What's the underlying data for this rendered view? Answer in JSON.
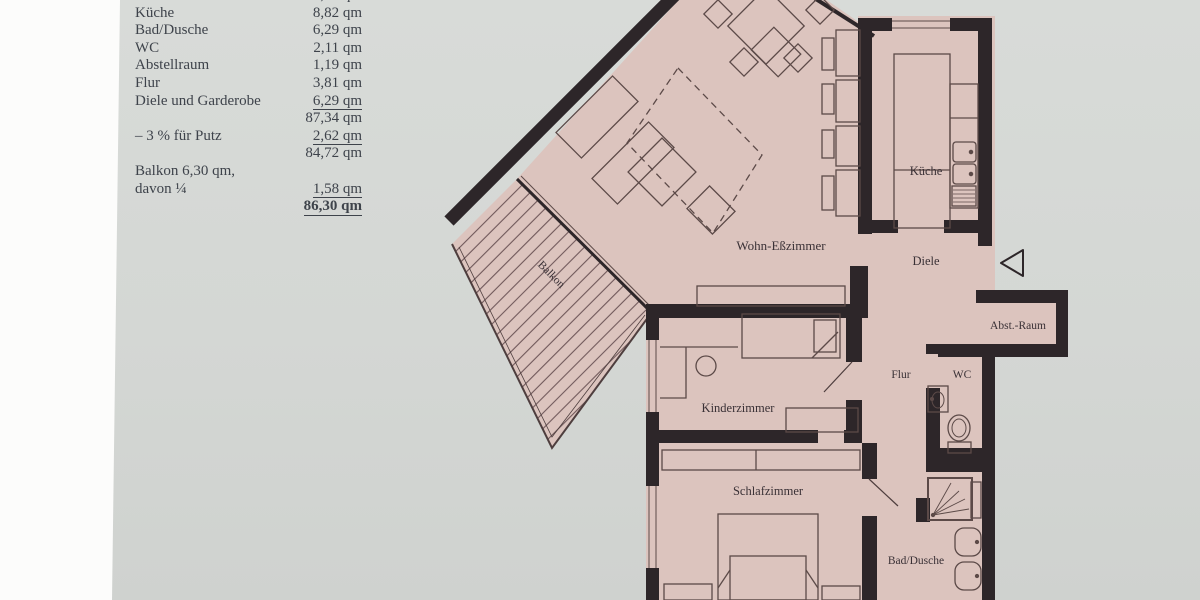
{
  "table": {
    "rows": [
      {
        "label": "Wohn- und Eßzimmer",
        "value": "58,83 qm"
      },
      {
        "label": "Küche",
        "value": "8,82 qm"
      },
      {
        "label": "Bad/Dusche",
        "value": "6,29 qm"
      },
      {
        "label": "WC",
        "value": "2,11 qm"
      },
      {
        "label": "Abstellraum",
        "value": "1,19 qm"
      },
      {
        "label": "Flur",
        "value": "3,81 qm"
      },
      {
        "label": "Diele und Garderobe",
        "value": "6,29 qm"
      },
      {
        "label": "",
        "value": "87,34 qm"
      },
      {
        "label": "– 3 % für Putz",
        "value": "2,62 qm"
      },
      {
        "label": "",
        "value": "84,72 qm"
      },
      {
        "label": "Balkon 6,30 qm,",
        "value": ""
      },
      {
        "label": "davon ¼",
        "value": "1,58 qm"
      },
      {
        "label": "",
        "value": "86,30 qm"
      }
    ]
  },
  "plan": {
    "labels": {
      "living": "Wohn-Eßzimmer",
      "kitchen": "Küche",
      "hall": "Diele",
      "storage": "Abst.-Raum",
      "corridor": "Flur",
      "wc": "WC",
      "child": "Kinderzimmer",
      "bedroom": "Schlafzimmer",
      "bath": "Bad/Dusche",
      "balcony": "Balkon"
    },
    "colors": {
      "floor": "#dcc4be",
      "wall": "#2d2629",
      "furniture_line": "#5c4a48",
      "photo_background": "#d5d8d5",
      "page_margin": "#fcfcfb",
      "table_text": "#3e434b"
    }
  },
  "icons": {
    "entry_arrow": "open-triangle-pointing-left"
  }
}
